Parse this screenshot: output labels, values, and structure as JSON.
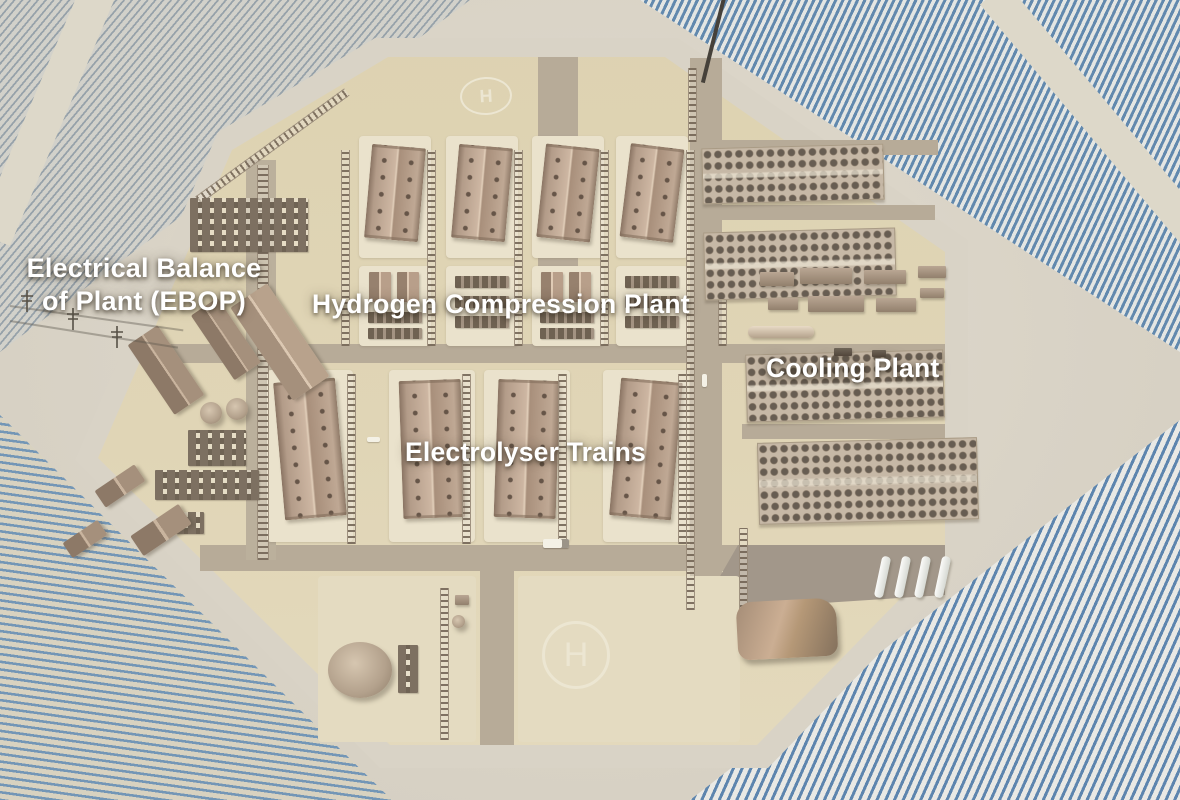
{
  "labels": {
    "ebop_line1": "Electrical Balance",
    "ebop_line2": "of Plant (EBOP)",
    "hydrogen_compression": "Hydrogen Compression Plant",
    "electrolyser": "Electrolyser Trains",
    "cooling": "Cooling Plant"
  },
  "helipad": {
    "symbol": "H"
  },
  "colors": {
    "ground": "#d9d3c6",
    "pad": "#ddd2b1",
    "pad_light": "#eae2cc",
    "road": "#b7ab98",
    "road_dark": "#a2978a",
    "solar_blue": "#6289ae",
    "solar_blue_light": "#97a2aa",
    "building_tan": "#bba494",
    "fan_dark": "#675d52",
    "label_text": "#ffffff"
  }
}
